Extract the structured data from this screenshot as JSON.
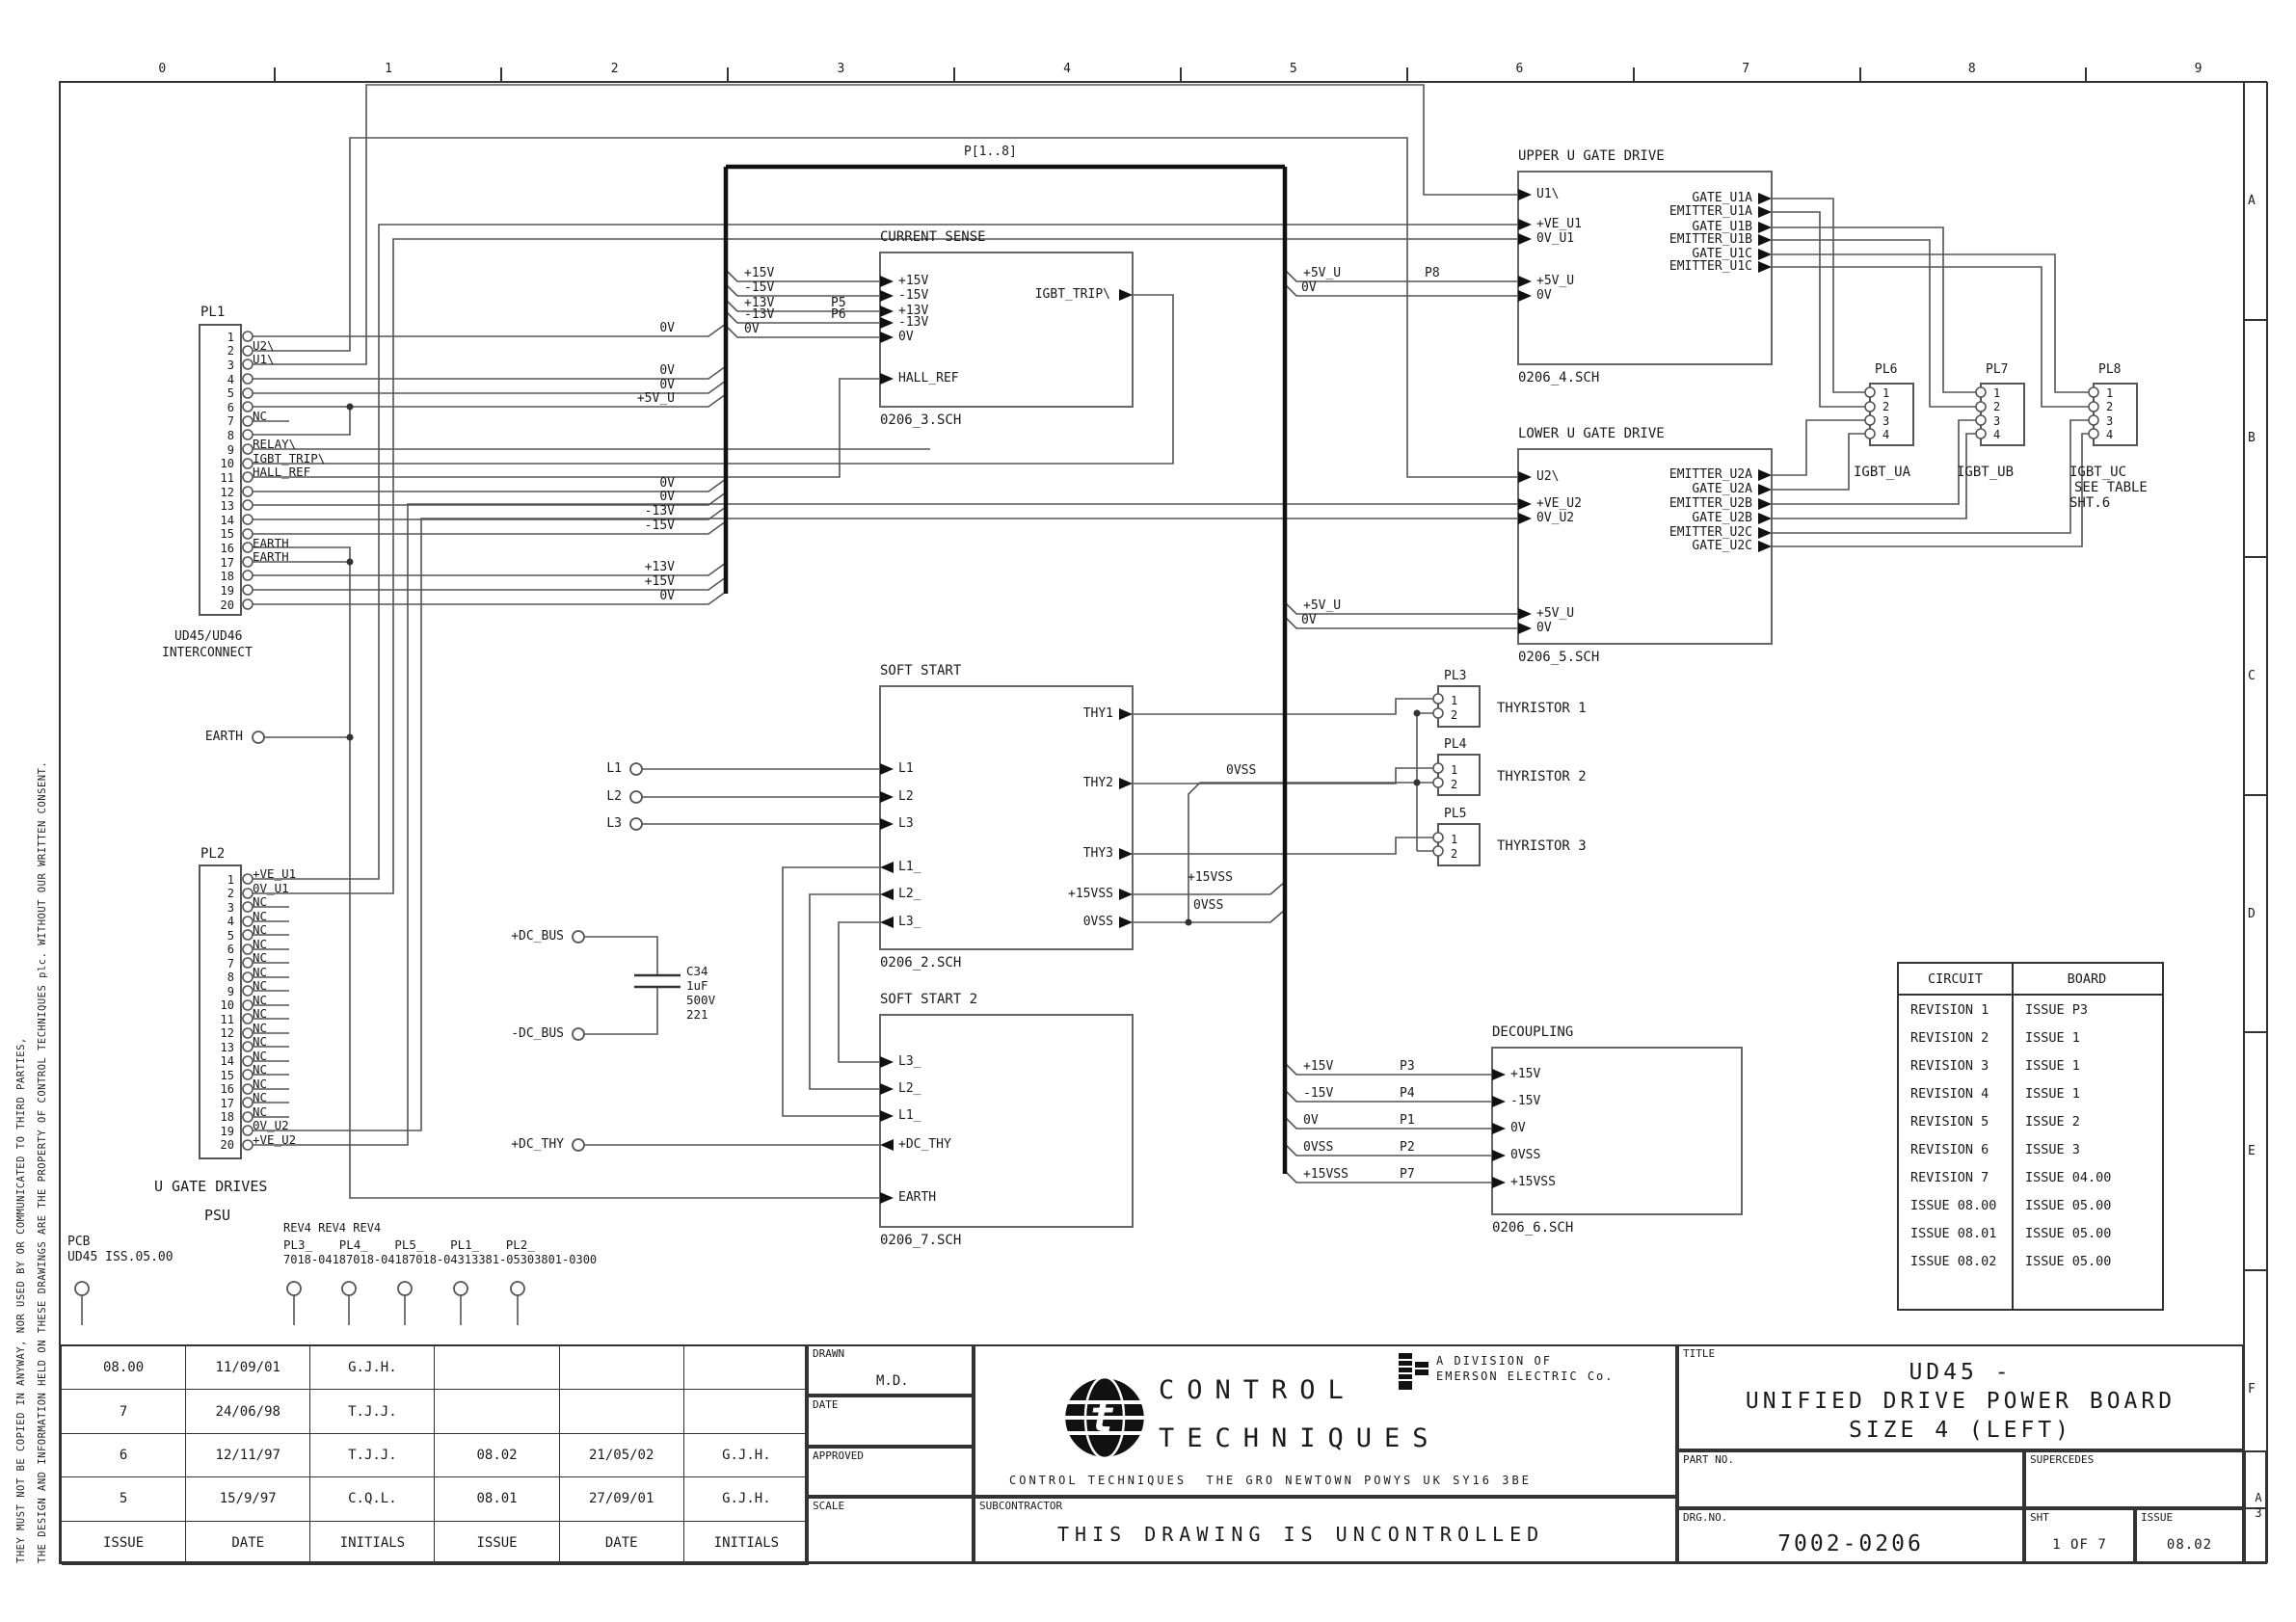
{
  "sheet": {
    "ruler": [
      "0",
      "1",
      "2",
      "3",
      "4",
      "5",
      "6",
      "7",
      "8",
      "9"
    ],
    "zones": [
      "A",
      "B",
      "C",
      "D",
      "E",
      "F"
    ],
    "size": "A3",
    "disclaimer1": "THE DESIGN AND INFORMATION HELD ON THESE DRAWINGS ARE THE PROPERTY OF CONTROL TECHNIQUES plc. WITHOUT OUR WRITTEN CONSENT.",
    "disclaimer2": "THEY MUST NOT BE COPIED IN ANYWAY, NOR USED BY OR COMMUNICATED TO THIRD PARTIES,"
  },
  "labels": {
    "bus": "P[1..8]",
    "pl1_far": [
      "0V",
      "0V",
      "0V",
      "+5V_U",
      "0V",
      "0V",
      "-13V",
      "-15V",
      "+13V",
      "+15V",
      "0V"
    ],
    "cs_taps": [
      "+15V",
      "-15V",
      "+13V",
      "-13V",
      "0V"
    ],
    "cs_p": [
      "P5",
      "P6"
    ],
    "up_taps": [
      "+5V_U",
      "0V"
    ],
    "up_p8": "P8",
    "lo_taps": [
      "+5V_U",
      "0V"
    ],
    "ss_out": [
      "+15VSS",
      "0VSS"
    ],
    "thy_ret": "0VSS",
    "dec_taps": [
      "+15V",
      "-15V",
      "0V",
      "0VSS",
      "+15VSS"
    ],
    "dec_p": [
      "P3",
      "P4",
      "P1",
      "P2",
      "P7"
    ],
    "earth": "EARTH",
    "lines": [
      "L1",
      "L2",
      "L3"
    ],
    "dc_pos": "+DC_BUS",
    "dc_neg": "-DC_BUS",
    "dc_thy": "+DC_THY",
    "cap": [
      "C34",
      "1uF",
      "500V",
      "221"
    ]
  },
  "blocks": {
    "current_sense": {
      "title": "CURRENT SENSE",
      "file": "0206_3.SCH",
      "left": [
        "+15V",
        "-15V",
        "+13V",
        "-13V",
        "0V",
        "HALL_REF"
      ],
      "right": [
        "IGBT_TRIP\\"
      ]
    },
    "upper": {
      "title": "UPPER U GATE DRIVE",
      "file": "0206_4.SCH",
      "left": [
        "U1\\",
        "+VE_U1",
        "0V_U1",
        "+5V_U",
        "0V"
      ],
      "right": [
        "GATE_U1A",
        "EMITTER_U1A",
        "GATE_U1B",
        "EMITTER_U1B",
        "GATE_U1C",
        "EMITTER_U1C"
      ]
    },
    "lower": {
      "title": "LOWER U GATE DRIVE",
      "file": "0206_5.SCH",
      "left": [
        "U2\\",
        "+VE_U2",
        "0V_U2",
        "+5V_U",
        "0V"
      ],
      "right": [
        "EMITTER_U2A",
        "GATE_U2A",
        "EMITTER_U2B",
        "GATE_U2B",
        "EMITTER_U2C",
        "GATE_U2C"
      ]
    },
    "soft_start": {
      "title": "SOFT START",
      "file": "0206_2.SCH",
      "left": [
        "L1",
        "L2",
        "L3",
        "L1_",
        "L2_",
        "L3_"
      ],
      "right": [
        "THY1",
        "THY2",
        "THY3",
        "+15VSS",
        "0VSS"
      ]
    },
    "soft_start2": {
      "title": "SOFT START 2",
      "file": "0206_7.SCH",
      "left": [
        "L3_",
        "L2_",
        "L1_",
        "+DC_THY",
        "EARTH"
      ]
    },
    "decoupling": {
      "title": "DECOUPLING",
      "file": "0206_6.SCH",
      "left": [
        "+15V",
        "-15V",
        "0V",
        "0VSS",
        "+15VSS"
      ]
    }
  },
  "connectors": {
    "pl1": {
      "label": "PL1",
      "caption1": "UD45/UD46",
      "caption2": "INTERCONNECT",
      "pins": [
        {
          "n": "1",
          "l": ""
        },
        {
          "n": "2",
          "l": "U2\\"
        },
        {
          "n": "3",
          "l": "U1\\"
        },
        {
          "n": "4",
          "l": ""
        },
        {
          "n": "5",
          "l": ""
        },
        {
          "n": "6",
          "l": ""
        },
        {
          "n": "7",
          "l": "NC"
        },
        {
          "n": "8",
          "l": ""
        },
        {
          "n": "9",
          "l": "RELAY\\"
        },
        {
          "n": "10",
          "l": "IGBT_TRIP\\"
        },
        {
          "n": "11",
          "l": "HALL_REF"
        },
        {
          "n": "12",
          "l": ""
        },
        {
          "n": "13",
          "l": ""
        },
        {
          "n": "14",
          "l": ""
        },
        {
          "n": "15",
          "l": ""
        },
        {
          "n": "16",
          "l": "EARTH"
        },
        {
          "n": "17",
          "l": "EARTH"
        },
        {
          "n": "18",
          "l": ""
        },
        {
          "n": "19",
          "l": ""
        },
        {
          "n": "20",
          "l": ""
        }
      ]
    },
    "pl2": {
      "label": "PL2",
      "pins": [
        {
          "n": "1",
          "l": "+VE_U1"
        },
        {
          "n": "2",
          "l": "0V_U1"
        },
        {
          "n": "3",
          "l": "NC"
        },
        {
          "n": "4",
          "l": "NC"
        },
        {
          "n": "5",
          "l": "NC"
        },
        {
          "n": "6",
          "l": "NC"
        },
        {
          "n": "7",
          "l": "NC"
        },
        {
          "n": "8",
          "l": "NC"
        },
        {
          "n": "9",
          "l": "NC"
        },
        {
          "n": "10",
          "l": "NC"
        },
        {
          "n": "11",
          "l": "NC"
        },
        {
          "n": "12",
          "l": "NC"
        },
        {
          "n": "13",
          "l": "NC"
        },
        {
          "n": "14",
          "l": "NC"
        },
        {
          "n": "15",
          "l": "NC"
        },
        {
          "n": "16",
          "l": "NC"
        },
        {
          "n": "17",
          "l": "NC"
        },
        {
          "n": "18",
          "l": "NC"
        },
        {
          "n": "19",
          "l": "0V_U2"
        },
        {
          "n": "20",
          "l": "+VE_U2"
        }
      ]
    },
    "pl3": {
      "label": "PL3",
      "caption": "THYRISTOR 1",
      "pins": [
        "1",
        "2"
      ]
    },
    "pl4": {
      "label": "PL4",
      "caption": "THYRISTOR 2",
      "pins": [
        "1",
        "2"
      ]
    },
    "pl5": {
      "label": "PL5",
      "caption": "THYRISTOR 3",
      "pins": [
        "1",
        "2"
      ]
    },
    "pl6": {
      "label": "PL6",
      "caption": "IGBT_UA",
      "pins": [
        "1",
        "2",
        "3",
        "4"
      ]
    },
    "pl7": {
      "label": "PL7",
      "caption": "IGBT_UB",
      "pins": [
        "1",
        "2",
        "3",
        "4"
      ]
    },
    "pl8": {
      "label": "PL8",
      "caption": "IGBT_UC",
      "note1": "SEE TABLE",
      "note2": "SHT.6",
      "pins": [
        "1",
        "2",
        "3",
        "4"
      ]
    }
  },
  "notes": {
    "u_gate_drives": "U GATE DRIVES",
    "psu": "PSU",
    "pcb": "PCB",
    "pcb_issue": "UD45 ISS.05.00",
    "rev4": "REV4 REV4 REV4",
    "pl_names": [
      "PL3_",
      "PL4_",
      "PL5_",
      "PL1_",
      "PL2_"
    ],
    "pl_parts": [
      "7018-0418",
      "7018-0418",
      "7018-0431",
      "3381-0530",
      "3801-0300"
    ]
  },
  "rev_table": {
    "headers": [
      "CIRCUIT",
      "BOARD"
    ],
    "rows": [
      [
        "REVISION 1",
        "ISSUE P3"
      ],
      [
        "REVISION 2",
        "ISSUE 1"
      ],
      [
        "REVISION 3",
        "ISSUE 1"
      ],
      [
        "REVISION 4",
        "ISSUE 1"
      ],
      [
        "REVISION 5",
        "ISSUE 2"
      ],
      [
        "REVISION 6",
        "ISSUE 3"
      ],
      [
        "REVISION 7",
        "ISSUE 04.00"
      ],
      [
        "ISSUE 08.00",
        "ISSUE 05.00"
      ],
      [
        "ISSUE 08.01",
        "ISSUE 05.00"
      ],
      [
        "ISSUE 08.02",
        "ISSUE 05.00"
      ]
    ]
  },
  "history": {
    "rows": [
      [
        "08.00",
        "11/09/01",
        "G.J.H.",
        "",
        "",
        ""
      ],
      [
        "7",
        "24/06/98",
        "T.J.J.",
        "",
        "",
        ""
      ],
      [
        "6",
        "12/11/97",
        "T.J.J.",
        "08.02",
        "21/05/02",
        "G.J.H."
      ],
      [
        "5",
        "15/9/97",
        "C.Q.L.",
        "08.01",
        "27/09/01",
        "G.J.H."
      ],
      [
        "ISSUE",
        "DATE",
        "INITIALS",
        "ISSUE",
        "DATE",
        "INITIALS"
      ]
    ]
  },
  "title_block": {
    "drawn_label": "DRAWN",
    "drawn": "M.D.",
    "date_label": "DATE",
    "approved_label": "APPROVED",
    "scale_label": "SCALE",
    "subcontractor_label": "SUBCONTRACTOR",
    "subcontractor": "THIS DRAWING IS UNCONTROLLED",
    "logo1": "CONTROL",
    "logo2": "TECHNIQUES",
    "division1": "A DIVISION OF",
    "division2": "EMERSON ELECTRIC Co.",
    "address": "CONTROL TECHNIQUES  THE GRO NEWTOWN POWYS UK SY16 3BE",
    "title_label": "TITLE",
    "title1": "UD45 -",
    "title2": "UNIFIED DRIVE POWER BOARD",
    "title3": "SIZE 4 (LEFT)",
    "partno_label": "PART NO.",
    "supercedes_label": "SUPERCEDES",
    "drg_label": "DRG.NO.",
    "drg": "7002-0206",
    "sht_label": "SHT",
    "sht": "1 OF 7",
    "issue_label": "ISSUE",
    "issue": "08.02"
  }
}
